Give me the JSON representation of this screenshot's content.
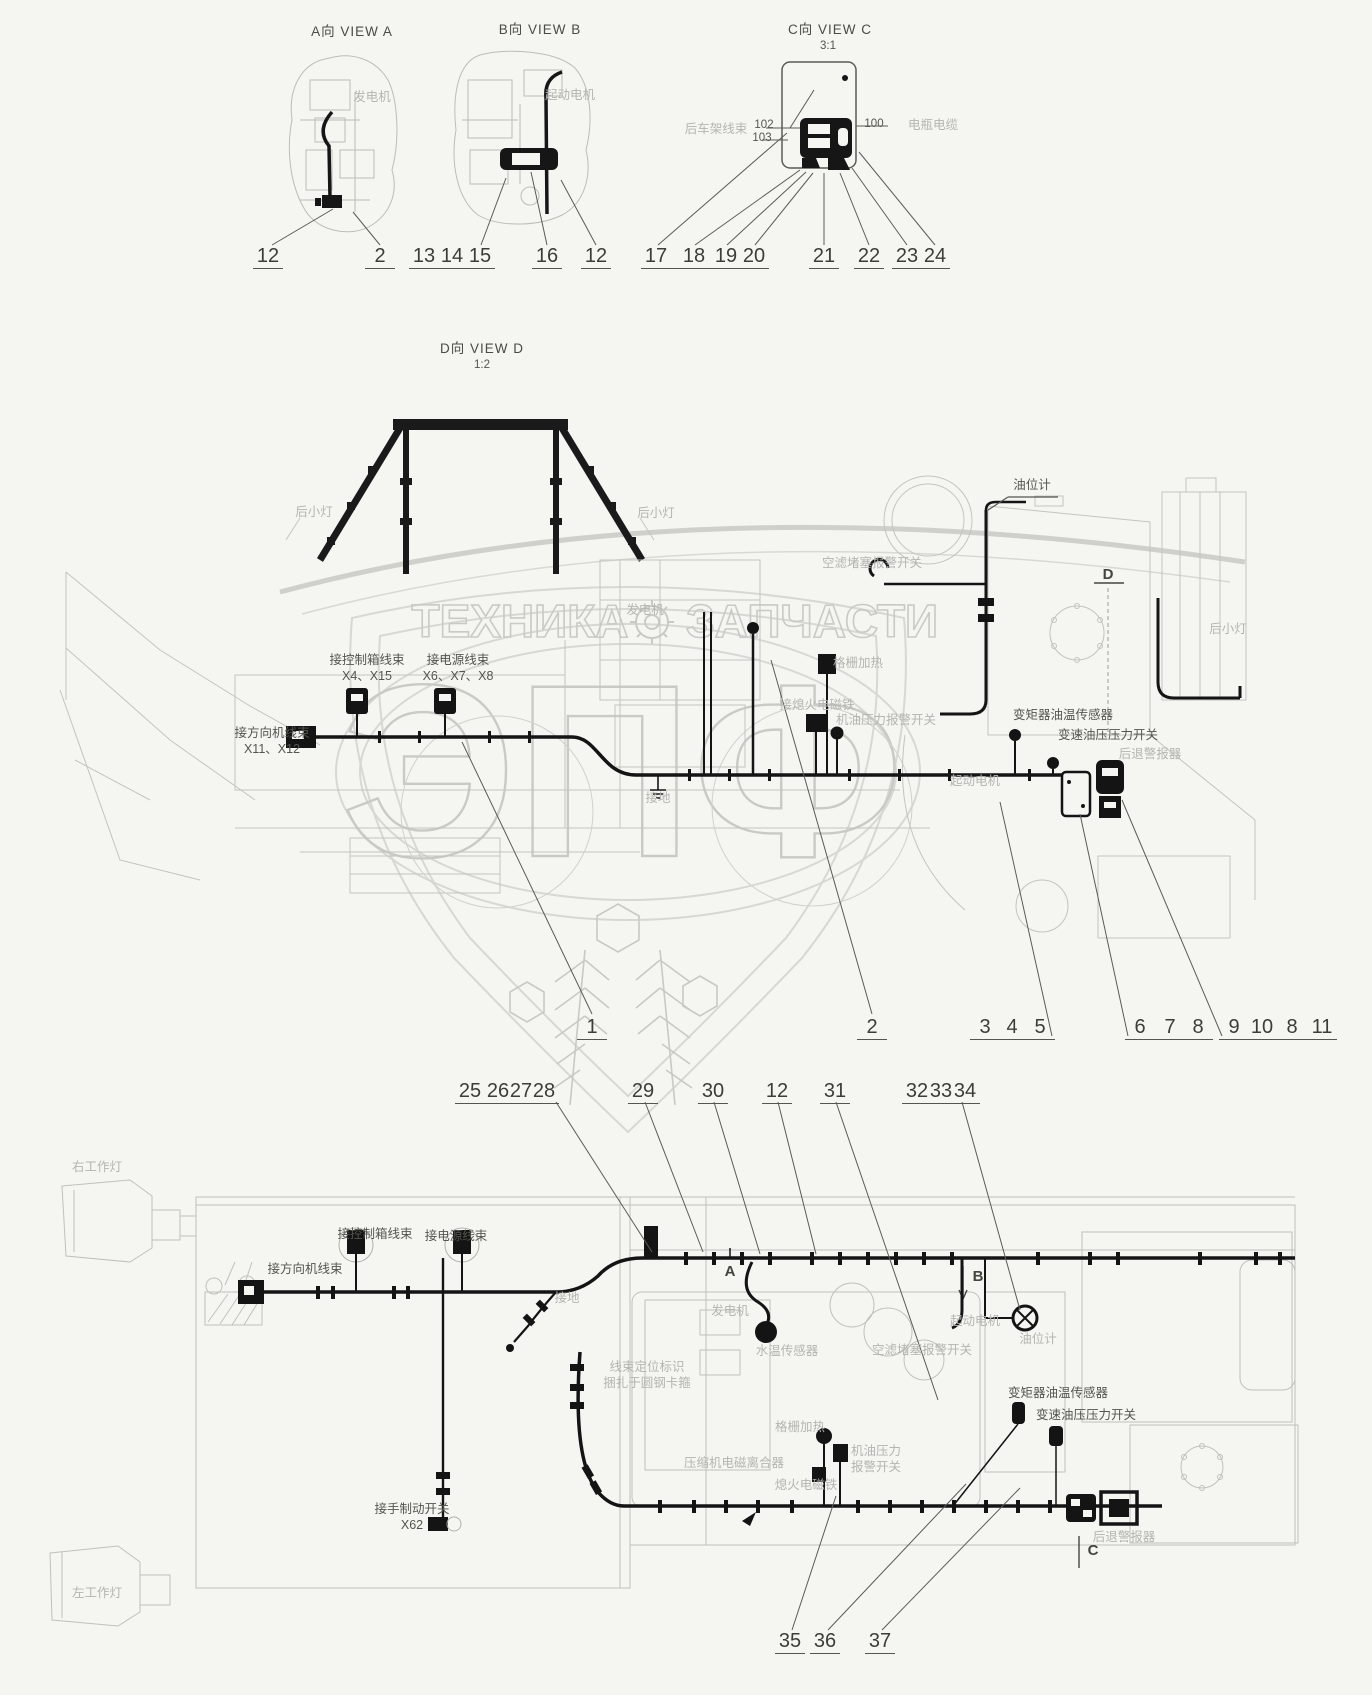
{
  "watermark": {
    "word1": "ТЕХНИКА",
    "word2": "ЗАПЧАСТИ",
    "monogram": "ЭПФ"
  },
  "views": {
    "a": {
      "title": "A向  VIEW A"
    },
    "b": {
      "title": "B向  VIEW B"
    },
    "c": {
      "title": "C向  VIEW C",
      "scale": "3:1"
    },
    "d": {
      "title": "D向  VIEW D",
      "scale": "1:2"
    }
  },
  "annotations": [
    {
      "name": "view-a-title",
      "lines": [
        "A向  VIEW A"
      ],
      "x": 352,
      "y": 24,
      "tone": "dark",
      "cls": "title"
    },
    {
      "name": "view-b-title",
      "lines": [
        "B向  VIEW B"
      ],
      "x": 540,
      "y": 22,
      "tone": "dark",
      "cls": "title"
    },
    {
      "name": "view-c-title",
      "lines": [
        "C向  VIEW C"
      ],
      "x": 830,
      "y": 22,
      "tone": "dark",
      "cls": "title"
    },
    {
      "name": "view-c-scale",
      "lines": [
        "3:1"
      ],
      "x": 828,
      "y": 39,
      "tone": "dark",
      "cls": "small"
    },
    {
      "name": "view-d-title",
      "lines": [
        "D向  VIEW D"
      ],
      "x": 482,
      "y": 341,
      "tone": "dark",
      "cls": "title"
    },
    {
      "name": "view-d-scale",
      "lines": [
        "1:2"
      ],
      "x": 482,
      "y": 358,
      "tone": "dark",
      "cls": "small"
    },
    {
      "name": "label-generator-view-a",
      "lines": [
        "发电机"
      ],
      "x": 372,
      "y": 90,
      "tone": "grey"
    },
    {
      "name": "label-starter-view-b",
      "lines": [
        "起动电机"
      ],
      "x": 570,
      "y": 88,
      "tone": "grey"
    },
    {
      "name": "label-rear-frame-harness",
      "lines": [
        "后车架线束"
      ],
      "x": 716,
      "y": 122,
      "tone": "grey"
    },
    {
      "name": "label-102",
      "lines": [
        "102"
      ],
      "x": 764,
      "y": 118,
      "tone": "dark",
      "cls": "small"
    },
    {
      "name": "label-103",
      "lines": [
        "103"
      ],
      "x": 762,
      "y": 131,
      "tone": "dark",
      "cls": "small"
    },
    {
      "name": "label-100",
      "lines": [
        "100"
      ],
      "x": 874,
      "y": 117,
      "tone": "dark",
      "cls": "small"
    },
    {
      "name": "label-battery-cable",
      "lines": [
        "电瓶电缆"
      ],
      "x": 933,
      "y": 118,
      "tone": "grey"
    },
    {
      "name": "label-rear-small-lamp-left",
      "lines": [
        "后小灯"
      ],
      "x": 314,
      "y": 505,
      "tone": "grey"
    },
    {
      "name": "label-rear-small-lamp-right",
      "lines": [
        "后小灯"
      ],
      "x": 656,
      "y": 506,
      "tone": "grey"
    },
    {
      "name": "label-oil-level-gauge-side",
      "lines": [
        "油位计"
      ],
      "x": 1032,
      "y": 478,
      "tone": "dark"
    },
    {
      "name": "label-air-filter-clog-alarm-switch-side",
      "lines": [
        "空滤堵塞报警开关"
      ],
      "x": 872,
      "y": 556,
      "tone": "grey"
    },
    {
      "name": "label-to-control-box-harness-side",
      "lines": [
        "接控制箱线束",
        "X4、X15"
      ],
      "x": 367,
      "y": 653,
      "tone": "dark"
    },
    {
      "name": "label-to-power-harness-side",
      "lines": [
        "接电源线束",
        "X6、X7、X8"
      ],
      "x": 458,
      "y": 653,
      "tone": "dark"
    },
    {
      "name": "label-generator-side",
      "lines": [
        "发电机"
      ],
      "x": 645,
      "y": 603,
      "tone": "grey"
    },
    {
      "name": "label-grid-heater-side",
      "lines": [
        "格栅加热"
      ],
      "x": 858,
      "y": 656,
      "tone": "grey"
    },
    {
      "name": "label-to-steering-harness-side",
      "lines": [
        "接方向机线束",
        "X11、X12"
      ],
      "x": 272,
      "y": 726,
      "tone": "dark"
    },
    {
      "name": "label-to-shutoff-solenoid-side",
      "lines": [
        "接熄火电磁铁"
      ],
      "x": 817,
      "y": 698,
      "tone": "grey"
    },
    {
      "name": "label-oil-pressure-alarm-switch-side",
      "lines": [
        "机油压力报警开关"
      ],
      "x": 886,
      "y": 713,
      "tone": "grey"
    },
    {
      "name": "label-starter-side",
      "lines": [
        "起动电机"
      ],
      "x": 975,
      "y": 774,
      "tone": "grey"
    },
    {
      "name": "label-tc-oil-temp-sensor-side",
      "lines": [
        "变矩器油温传感器"
      ],
      "x": 1063,
      "y": 708,
      "tone": "dark"
    },
    {
      "name": "label-trans-oil-pressure-switch-side",
      "lines": [
        "变速油压压力开关"
      ],
      "x": 1108,
      "y": 728,
      "tone": "dark"
    },
    {
      "name": "label-reverse-alarm-side",
      "lines": [
        "后退警报器"
      ],
      "x": 1150,
      "y": 747,
      "tone": "grey"
    },
    {
      "name": "label-ground-side",
      "lines": [
        "接地"
      ],
      "x": 658,
      "y": 791,
      "tone": "grey"
    },
    {
      "name": "label-rear-small-lamp-side",
      "lines": [
        "后小灯"
      ],
      "x": 1228,
      "y": 622,
      "tone": "grey"
    },
    {
      "name": "label-right-work-lamp",
      "lines": [
        "右工作灯"
      ],
      "x": 97,
      "y": 1160,
      "tone": "grey"
    },
    {
      "name": "label-to-control-box-harness-top",
      "lines": [
        "接控制箱线束"
      ],
      "x": 375,
      "y": 1227,
      "tone": "dark"
    },
    {
      "name": "label-to-power-harness-top",
      "lines": [
        "接电源线束"
      ],
      "x": 456,
      "y": 1229,
      "tone": "dark"
    },
    {
      "name": "label-to-steering-harness-top",
      "lines": [
        "接方向机线束"
      ],
      "x": 305,
      "y": 1262,
      "tone": "dark"
    },
    {
      "name": "label-ground-top",
      "lines": [
        "接地"
      ],
      "x": 567,
      "y": 1291,
      "tone": "grey"
    },
    {
      "name": "label-generator-top",
      "lines": [
        "发电机"
      ],
      "x": 730,
      "y": 1304,
      "tone": "grey"
    },
    {
      "name": "label-water-temp-sensor-top",
      "lines": [
        "水温传感器"
      ],
      "x": 787,
      "y": 1344,
      "tone": "grey"
    },
    {
      "name": "label-air-filter-clog-alarm-switch-top",
      "lines": [
        "空滤堵塞报警开关"
      ],
      "x": 922,
      "y": 1343,
      "tone": "grey"
    },
    {
      "name": "label-starter-top",
      "lines": [
        "起动电机"
      ],
      "x": 975,
      "y": 1314,
      "tone": "grey"
    },
    {
      "name": "label-oil-level-gauge-top",
      "lines": [
        "油位计"
      ],
      "x": 1038,
      "y": 1332,
      "tone": "grey"
    },
    {
      "name": "label-harness-position-mark",
      "lines": [
        "线束定位标识",
        "捆扎于圆钢卡箍"
      ],
      "x": 647,
      "y": 1360,
      "tone": "grey"
    },
    {
      "name": "label-grid-heater-top",
      "lines": [
        "格栅加热"
      ],
      "x": 800,
      "y": 1420,
      "tone": "grey"
    },
    {
      "name": "label-compressor-clutch-top",
      "lines": [
        "压缩机电磁离合器"
      ],
      "x": 734,
      "y": 1456,
      "tone": "grey"
    },
    {
      "name": "label-shutoff-solenoid-top",
      "lines": [
        "熄火电磁铁"
      ],
      "x": 806,
      "y": 1478,
      "tone": "grey"
    },
    {
      "name": "label-oil-pressure-alarm-switch-top",
      "lines": [
        "机油压力",
        "报警开关"
      ],
      "x": 876,
      "y": 1444,
      "tone": "grey"
    },
    {
      "name": "label-tc-oil-temp-sensor-top",
      "lines": [
        "变矩器油温传感器"
      ],
      "x": 1058,
      "y": 1386,
      "tone": "dark"
    },
    {
      "name": "label-trans-oil-pressure-switch-top",
      "lines": [
        "变速油压压力开关"
      ],
      "x": 1086,
      "y": 1408,
      "tone": "dark"
    },
    {
      "name": "label-reverse-alarm-top",
      "lines": [
        "后退警报器"
      ],
      "x": 1124,
      "y": 1530,
      "tone": "grey"
    },
    {
      "name": "label-to-handbrake-switch",
      "lines": [
        "接手制动开关",
        "X62"
      ],
      "x": 412,
      "y": 1502,
      "tone": "dark"
    },
    {
      "name": "label-left-work-lamp",
      "lines": [
        "左工作灯"
      ],
      "x": 97,
      "y": 1586,
      "tone": "grey"
    }
  ],
  "markers": [
    {
      "t": "D",
      "x": 1108,
      "y": 566
    },
    {
      "t": "A",
      "x": 730,
      "y": 1263
    },
    {
      "t": "B",
      "x": 978,
      "y": 1268
    },
    {
      "t": "C",
      "x": 1093,
      "y": 1542
    }
  ],
  "callout_rows": [
    {
      "y": 245,
      "groups": [
        {
          "items": [
            {
              "n": "12",
              "x": 268
            }
          ]
        },
        {
          "items": [
            {
              "n": "2",
              "x": 380
            }
          ]
        },
        {
          "items": [
            {
              "n": "13",
              "x": 424
            },
            {
              "n": "14",
              "x": 452
            },
            {
              "n": "15",
              "x": 480
            }
          ]
        },
        {
          "items": [
            {
              "n": "16",
              "x": 547
            }
          ]
        },
        {
          "items": [
            {
              "n": "12",
              "x": 596
            }
          ]
        },
        {
          "items": [
            {
              "n": "17",
              "x": 656
            },
            {
              "n": "18",
              "x": 694
            },
            {
              "n": "19",
              "x": 726
            },
            {
              "n": "20",
              "x": 754
            }
          ]
        },
        {
          "items": [
            {
              "n": "21",
              "x": 824
            }
          ]
        },
        {
          "items": [
            {
              "n": "22",
              "x": 869
            }
          ]
        },
        {
          "items": [
            {
              "n": "23",
              "x": 907
            },
            {
              "n": "24",
              "x": 935
            }
          ]
        }
      ]
    },
    {
      "y": 1016,
      "groups": [
        {
          "items": [
            {
              "n": "1",
              "x": 592
            }
          ]
        },
        {
          "items": [
            {
              "n": "2",
              "x": 872
            }
          ]
        },
        {
          "items": [
            {
              "n": "3",
              "x": 985
            },
            {
              "n": "4",
              "x": 1012
            },
            {
              "n": "5",
              "x": 1040
            }
          ]
        },
        {
          "items": [
            {
              "n": "6",
              "x": 1140
            },
            {
              "n": "7",
              "x": 1170
            },
            {
              "n": "8",
              "x": 1198
            }
          ]
        },
        {
          "items": [
            {
              "n": "9",
              "x": 1234
            },
            {
              "n": "10",
              "x": 1262
            },
            {
              "n": "8",
              "x": 1292
            },
            {
              "n": "11",
              "x": 1322
            }
          ]
        }
      ]
    },
    {
      "y": 1080,
      "groups": [
        {
          "items": [
            {
              "n": "25",
              "x": 470
            },
            {
              "n": "26",
              "x": 498
            },
            {
              "n": "27",
              "x": 521
            },
            {
              "n": "28",
              "x": 544
            }
          ]
        },
        {
          "items": [
            {
              "n": "29",
              "x": 643
            }
          ]
        },
        {
          "items": [
            {
              "n": "30",
              "x": 713
            }
          ]
        },
        {
          "items": [
            {
              "n": "12",
              "x": 777
            }
          ]
        },
        {
          "items": [
            {
              "n": "31",
              "x": 835
            }
          ]
        },
        {
          "items": [
            {
              "n": "32",
              "x": 917
            },
            {
              "n": "33",
              "x": 941
            },
            {
              "n": "34",
              "x": 965
            }
          ]
        }
      ]
    },
    {
      "y": 1630,
      "groups": [
        {
          "items": [
            {
              "n": "35",
              "x": 790
            }
          ]
        },
        {
          "items": [
            {
              "n": "36",
              "x": 825
            }
          ]
        },
        {
          "items": [
            {
              "n": "37",
              "x": 880
            }
          ]
        }
      ]
    }
  ]
}
